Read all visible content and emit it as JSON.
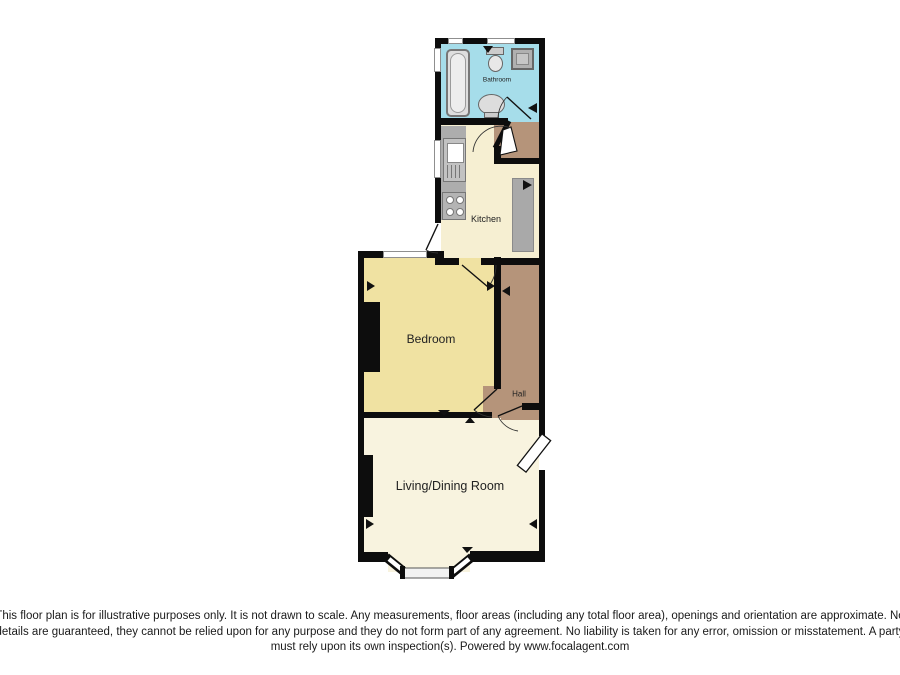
{
  "title": "Flat floor plan",
  "rooms": {
    "bathroom": "Bathroom",
    "kitchen": "Kitchen",
    "bedroom": "Bedroom",
    "hall": "Hall",
    "living": "Living/Dining Room"
  },
  "fixtures": {
    "bathtub": "bathtub",
    "toilet": "toilet",
    "shower": "shower-cubicle",
    "basin": "wash-basin",
    "sink_unit": "kitchen-sink-drainer",
    "hob": "four-ring-hob",
    "worktop": "worktop",
    "storage": "storage-block"
  },
  "disclaimer": {
    "lines": [
      "This floor plan is for illustrative purposes only. It is not drawn to scale. Any measurements, floor areas (including any total floor area), openings and orientation are approximate. No",
      "details are guaranteed, they cannot be relied upon for any purpose and they do not form part of any agreement. No liability is taken for any error, omission or misstatement. A party",
      "must rely upon its own inspection(s). Powered by www.focalagent.com"
    ]
  },
  "colors": {
    "bathroom_floor": "#A6DDEA",
    "kitchen_floor": "#F6EFD2",
    "bedroom_floor": "#F0E2A2",
    "living_floor": "#F8F3DF",
    "hall_floor": "#B5947A",
    "wall": "#0D0D0D"
  }
}
